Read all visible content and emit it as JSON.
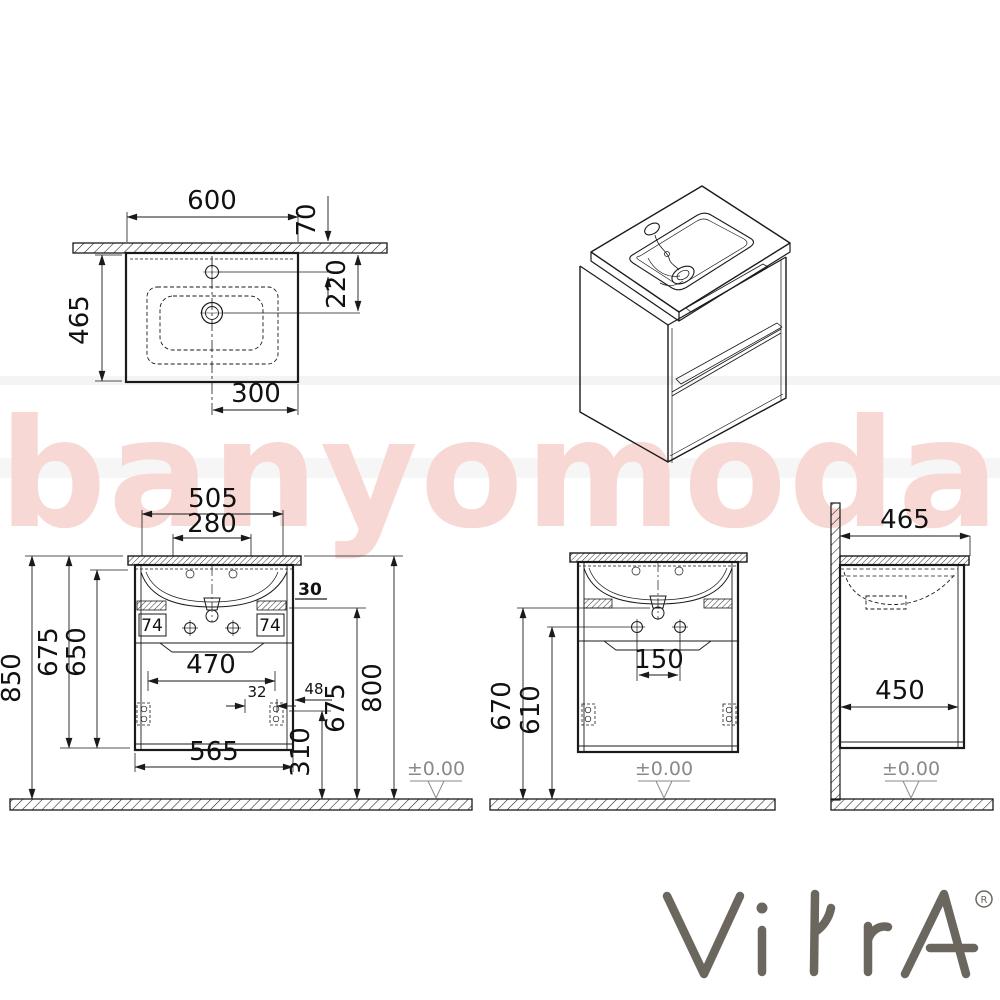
{
  "watermark": {
    "text": "banyomoda",
    "color": "#f8d8d4"
  },
  "brand": {
    "name": "VitrA",
    "registered": "R",
    "color": "#6b675f"
  },
  "colors": {
    "line": "#1a1a1a",
    "datum_gray": "#8a8a8a"
  },
  "top_view": {
    "width": "600",
    "back_offset": "70",
    "depth": "465",
    "drain_from_wall": "220",
    "drain_offset": "300"
  },
  "front_view": {
    "top_width": "505",
    "tap_spacing": "280",
    "total_height": "850",
    "height_675_left": "675",
    "height_650": "650",
    "rail_left": "74",
    "rail_right": "74",
    "gap_30": "30",
    "inner_width": "470",
    "hinge_offset": "32",
    "clearance_48": "48",
    "height_675_right": "675",
    "height_800": "800",
    "hinge_height": "310",
    "body_width": "565",
    "datum": "±0.00"
  },
  "middle_view": {
    "drain_height": "670",
    "hole_height": "610",
    "hole_spacing": "150",
    "datum": "±0.00"
  },
  "side_view": {
    "depth": "465",
    "inner_depth": "450",
    "datum": "±0.00"
  }
}
